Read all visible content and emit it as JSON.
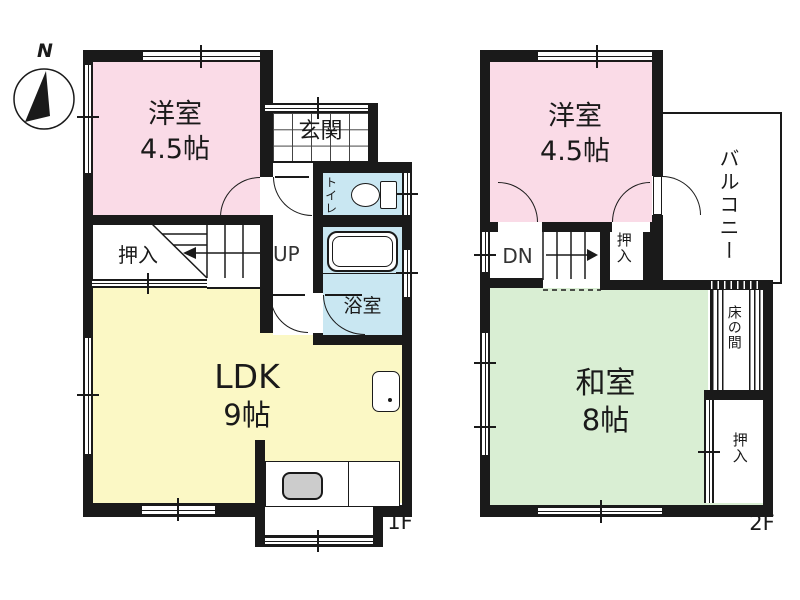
{
  "compass": {
    "north_label": "N"
  },
  "floor_1": {
    "floor_label": "1F",
    "western_room": {
      "name": "洋室",
      "size": "4.5帖"
    },
    "entrance": {
      "name": "玄関"
    },
    "toilet": {
      "name": "トイレ"
    },
    "closet": {
      "name": "押入"
    },
    "stairs_label": "UP",
    "bathroom": {
      "name": "浴室"
    },
    "ldk": {
      "name": "LDK",
      "size": "9帖"
    }
  },
  "floor_2": {
    "floor_label": "2F",
    "western_room": {
      "name": "洋室",
      "size": "4.5帖"
    },
    "balcony": {
      "name": "バルコニー"
    },
    "stairs_label": "DN",
    "closet_upper": {
      "name": "押入"
    },
    "japanese_room": {
      "name": "和室",
      "size": "8帖"
    },
    "tokonoma": {
      "name": "床の間"
    },
    "closet_lower": {
      "name": "押入"
    }
  },
  "colors": {
    "wall": "#1a1a1a",
    "western_room_fill": "#fadbe7",
    "ldk_fill": "#fbf8c5",
    "japanese_room_fill": "#d9eed3",
    "wet_area_fill": "#c9e7f2",
    "stove_fill": "#cccccc",
    "background": "#ffffff"
  }
}
